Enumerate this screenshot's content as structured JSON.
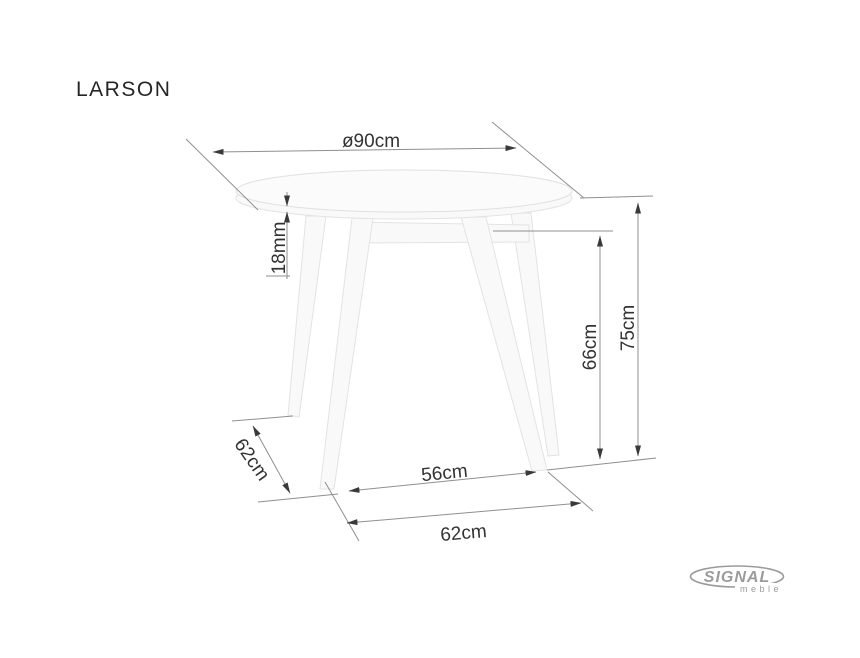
{
  "product": {
    "name": "LARSON"
  },
  "dimensions": {
    "top_diameter": "ø90cm",
    "top_thickness": "18mm",
    "underside_height": "66cm",
    "total_height": "75cm",
    "front_leg_spacing": "56cm",
    "base_width": "62cm",
    "base_depth": "62cm"
  },
  "brand": {
    "name": "SIGNAL",
    "tagline": "meble"
  },
  "colors": {
    "background": "#ffffff",
    "dimension_lines": "#8f8f8f",
    "dimension_text": "#333333",
    "arrowheads": "#3a3a3a",
    "drawing_outline": "#e3e3e3",
    "logo": "#9b9b9b"
  }
}
